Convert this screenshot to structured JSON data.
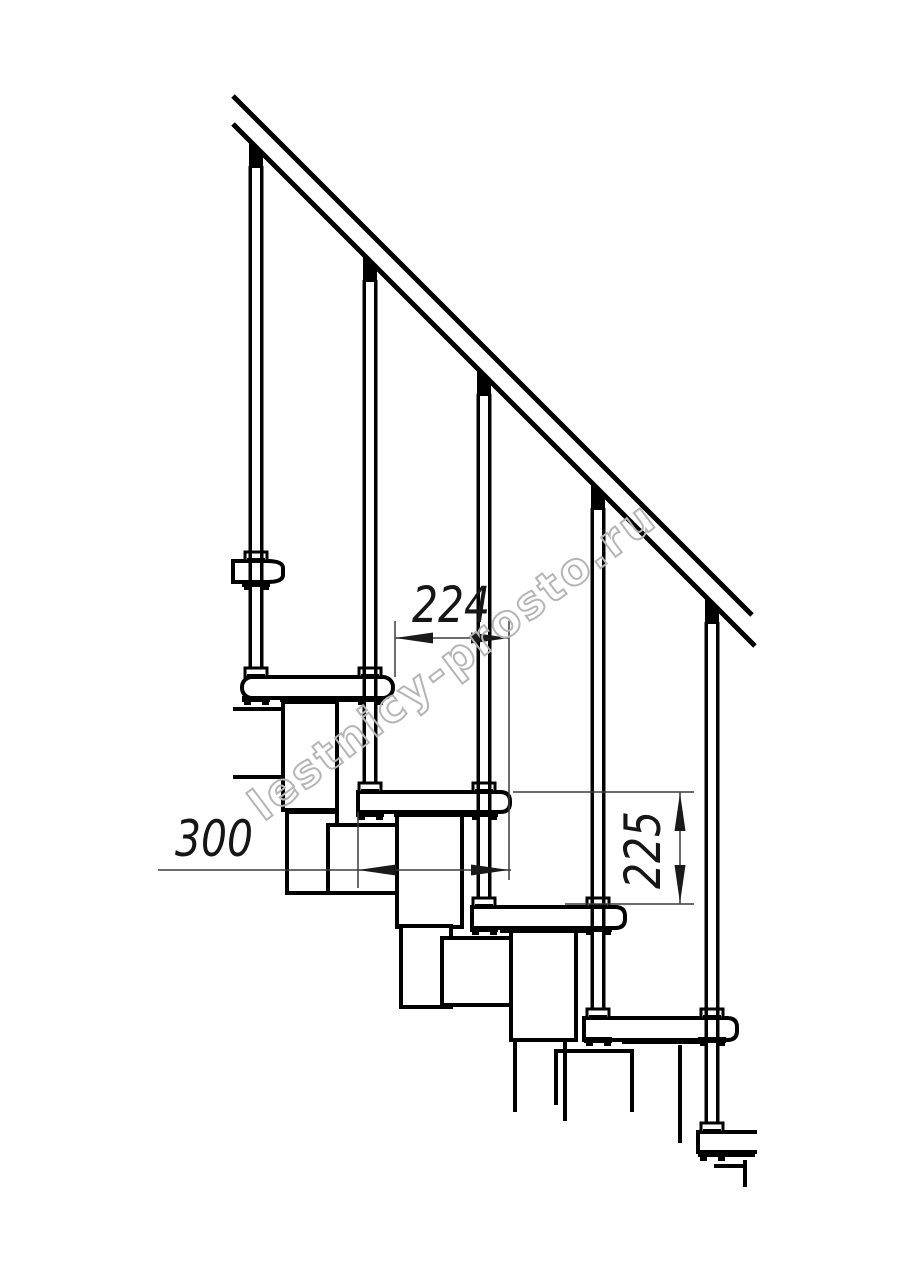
{
  "drawing": {
    "kind": "staircase-side-elevation",
    "watermark": {
      "text": "lestnicy-prosto.ru"
    },
    "dimensions": {
      "step_run": {
        "value": "224"
      },
      "tread_depth": {
        "value": "300"
      },
      "step_rise": {
        "value": "225"
      }
    },
    "structure": {
      "handrail": true,
      "baluster_count": 5,
      "tread_count": 6
    },
    "colors": {
      "ink": "#000000",
      "dimension_line": "#3c3c3c",
      "dimension_text": "#161616",
      "watermark": "#b5b5b5",
      "background": "#ffffff"
    }
  }
}
